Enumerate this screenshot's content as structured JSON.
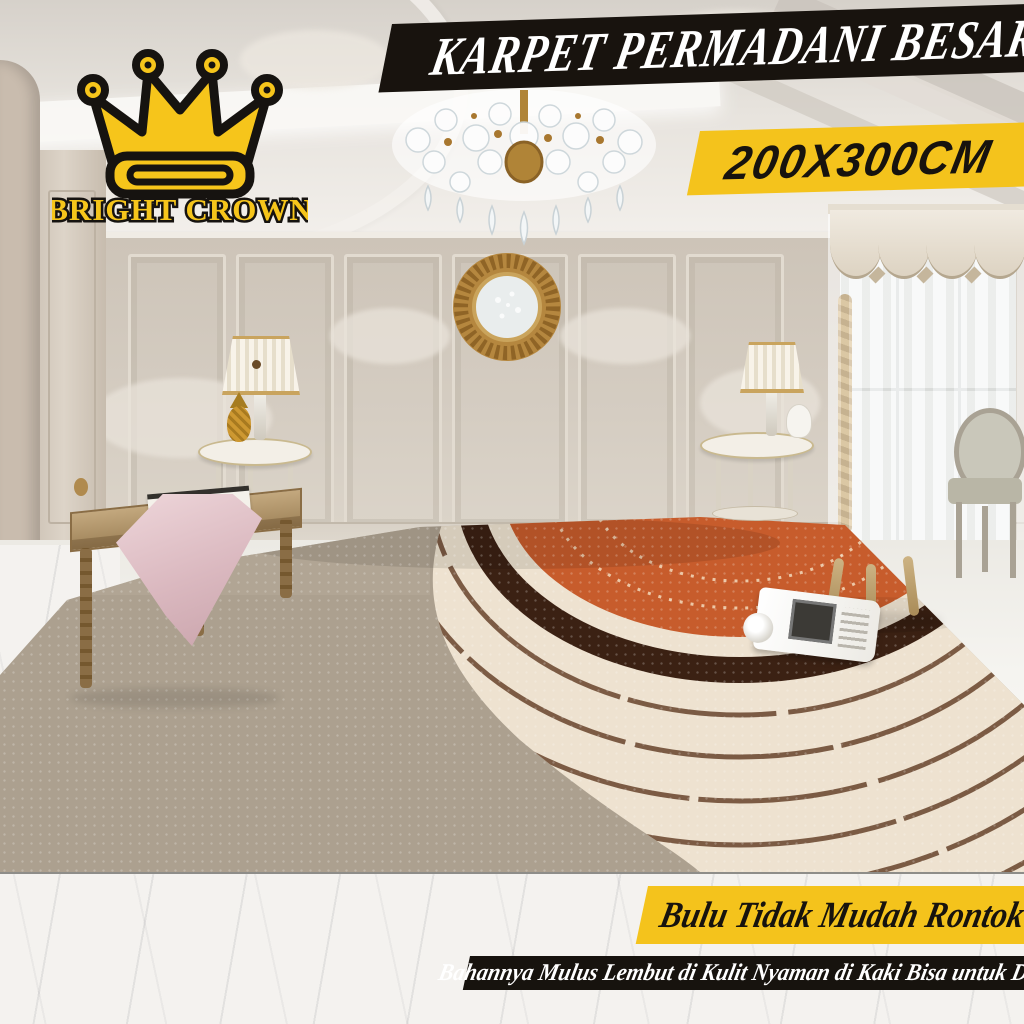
{
  "brand": {
    "name": "BRIGHT CROWN",
    "logo_icon": "crown-icon",
    "logo_fill": "#F6C51B",
    "logo_outline": "#161310"
  },
  "banners": {
    "title": "KARPET PERMADANI BESAR",
    "size": "200X300CM",
    "feature1": "Bulu Tidak Mudah Rontok",
    "feature2": "Bahannya Mulus Lembut di Kulit Nyaman di Kaki Bisa untuk Duduk"
  },
  "colors": {
    "banner_black": "#18130E",
    "banner_yellow": "#F4C31C",
    "banner_text_light": "#FFFFFF",
    "banner_text_dark": "#17130E",
    "carpet_orange": "#C75C2C",
    "carpet_dark_brown": "#3B2113",
    "carpet_arc_brown": "#6F4D35",
    "carpet_cream": "#EEE2D0",
    "carpet_taupe": "#ACA08F"
  },
  "scene": {
    "objects": [
      "crystal-chandelier",
      "sunburst-mirror",
      "classic-sofa",
      "throw-pillows",
      "flower-bouquet-pillow",
      "table-lamp-left",
      "table-lamp-right",
      "round-side-table-left",
      "round-side-table-right",
      "wooden-bench",
      "pink-runner-cloth",
      "gold-pineapple-ornament",
      "bergere-armchair",
      "gray-oval-chair",
      "sheer-curtain-window",
      "scalloped-valance",
      "arc-pattern-rug",
      "open-magazine",
      "marble-floor"
    ]
  }
}
